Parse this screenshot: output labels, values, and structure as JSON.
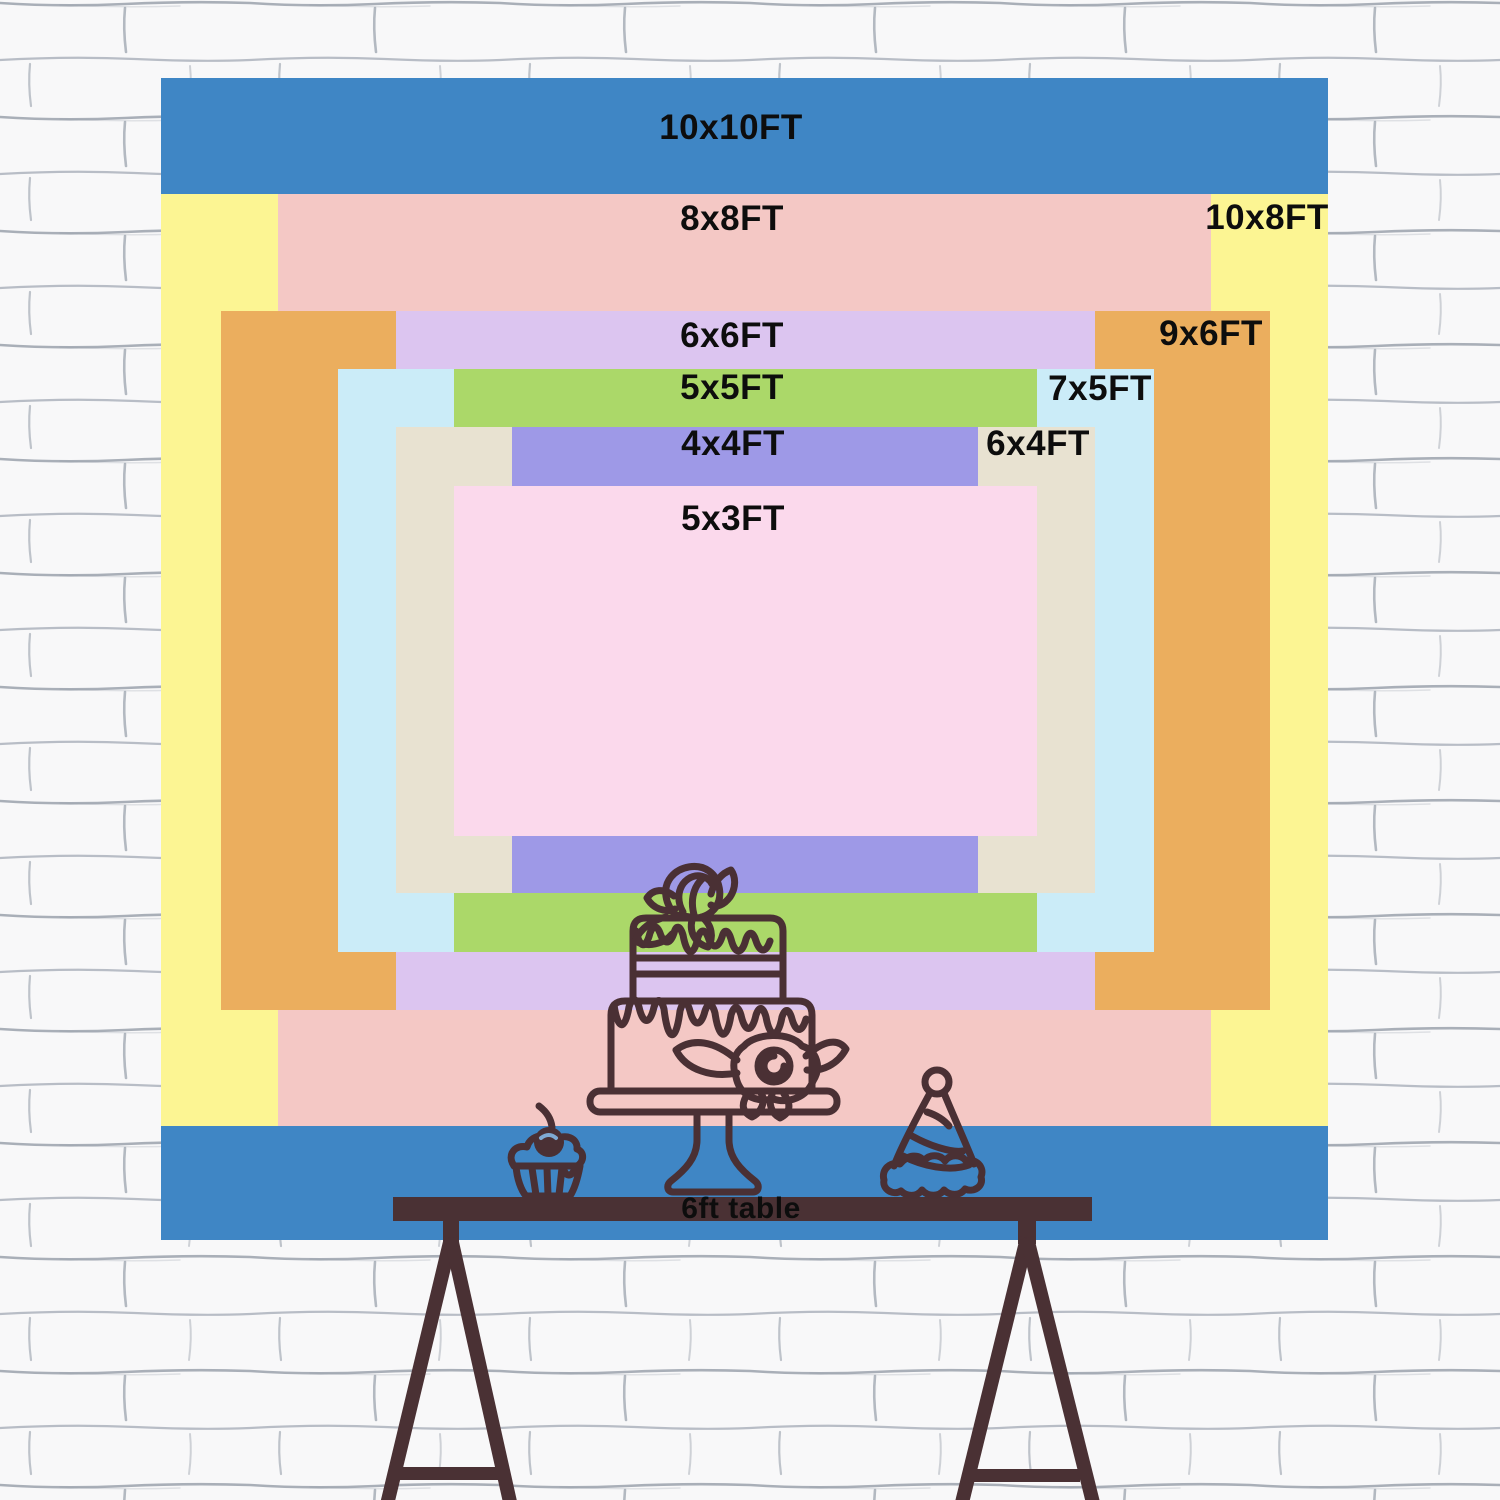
{
  "backdrop": {
    "sizes": [
      {
        "id": "10x10",
        "label": "10x10FT",
        "color": "#3f86c5"
      },
      {
        "id": "10x8",
        "label": "10x8FT",
        "color": "#fcf593"
      },
      {
        "id": "8x8",
        "label": "8x8FT",
        "color": "#f4c8c5"
      },
      {
        "id": "9x6",
        "label": "9x6FT",
        "color": "#ebae5e"
      },
      {
        "id": "6x6",
        "label": "6x6FT",
        "color": "#dcc5f0"
      },
      {
        "id": "7x5",
        "label": "7x5FT",
        "color": "#cbecf8"
      },
      {
        "id": "5x5",
        "label": "5x5FT",
        "color": "#abd869"
      },
      {
        "id": "6x4",
        "label": "6x4FT",
        "color": "#e8e2d1"
      },
      {
        "id": "4x4",
        "label": "4x4FT",
        "color": "#9e99e7"
      },
      {
        "id": "5x3",
        "label": "5x3FT",
        "color": "#fbd9ec"
      }
    ],
    "label_color": "#0d0d0d"
  },
  "table": {
    "label": "6ft table",
    "color": "#4a3134"
  },
  "illustration": {
    "line_color": "#4a3034",
    "items": [
      "two-tier cake on stand",
      "cupcake with cherry",
      "party hat"
    ]
  },
  "wall": {
    "color": "#f8f8f9",
    "mortar_color": "#8e96a3"
  }
}
